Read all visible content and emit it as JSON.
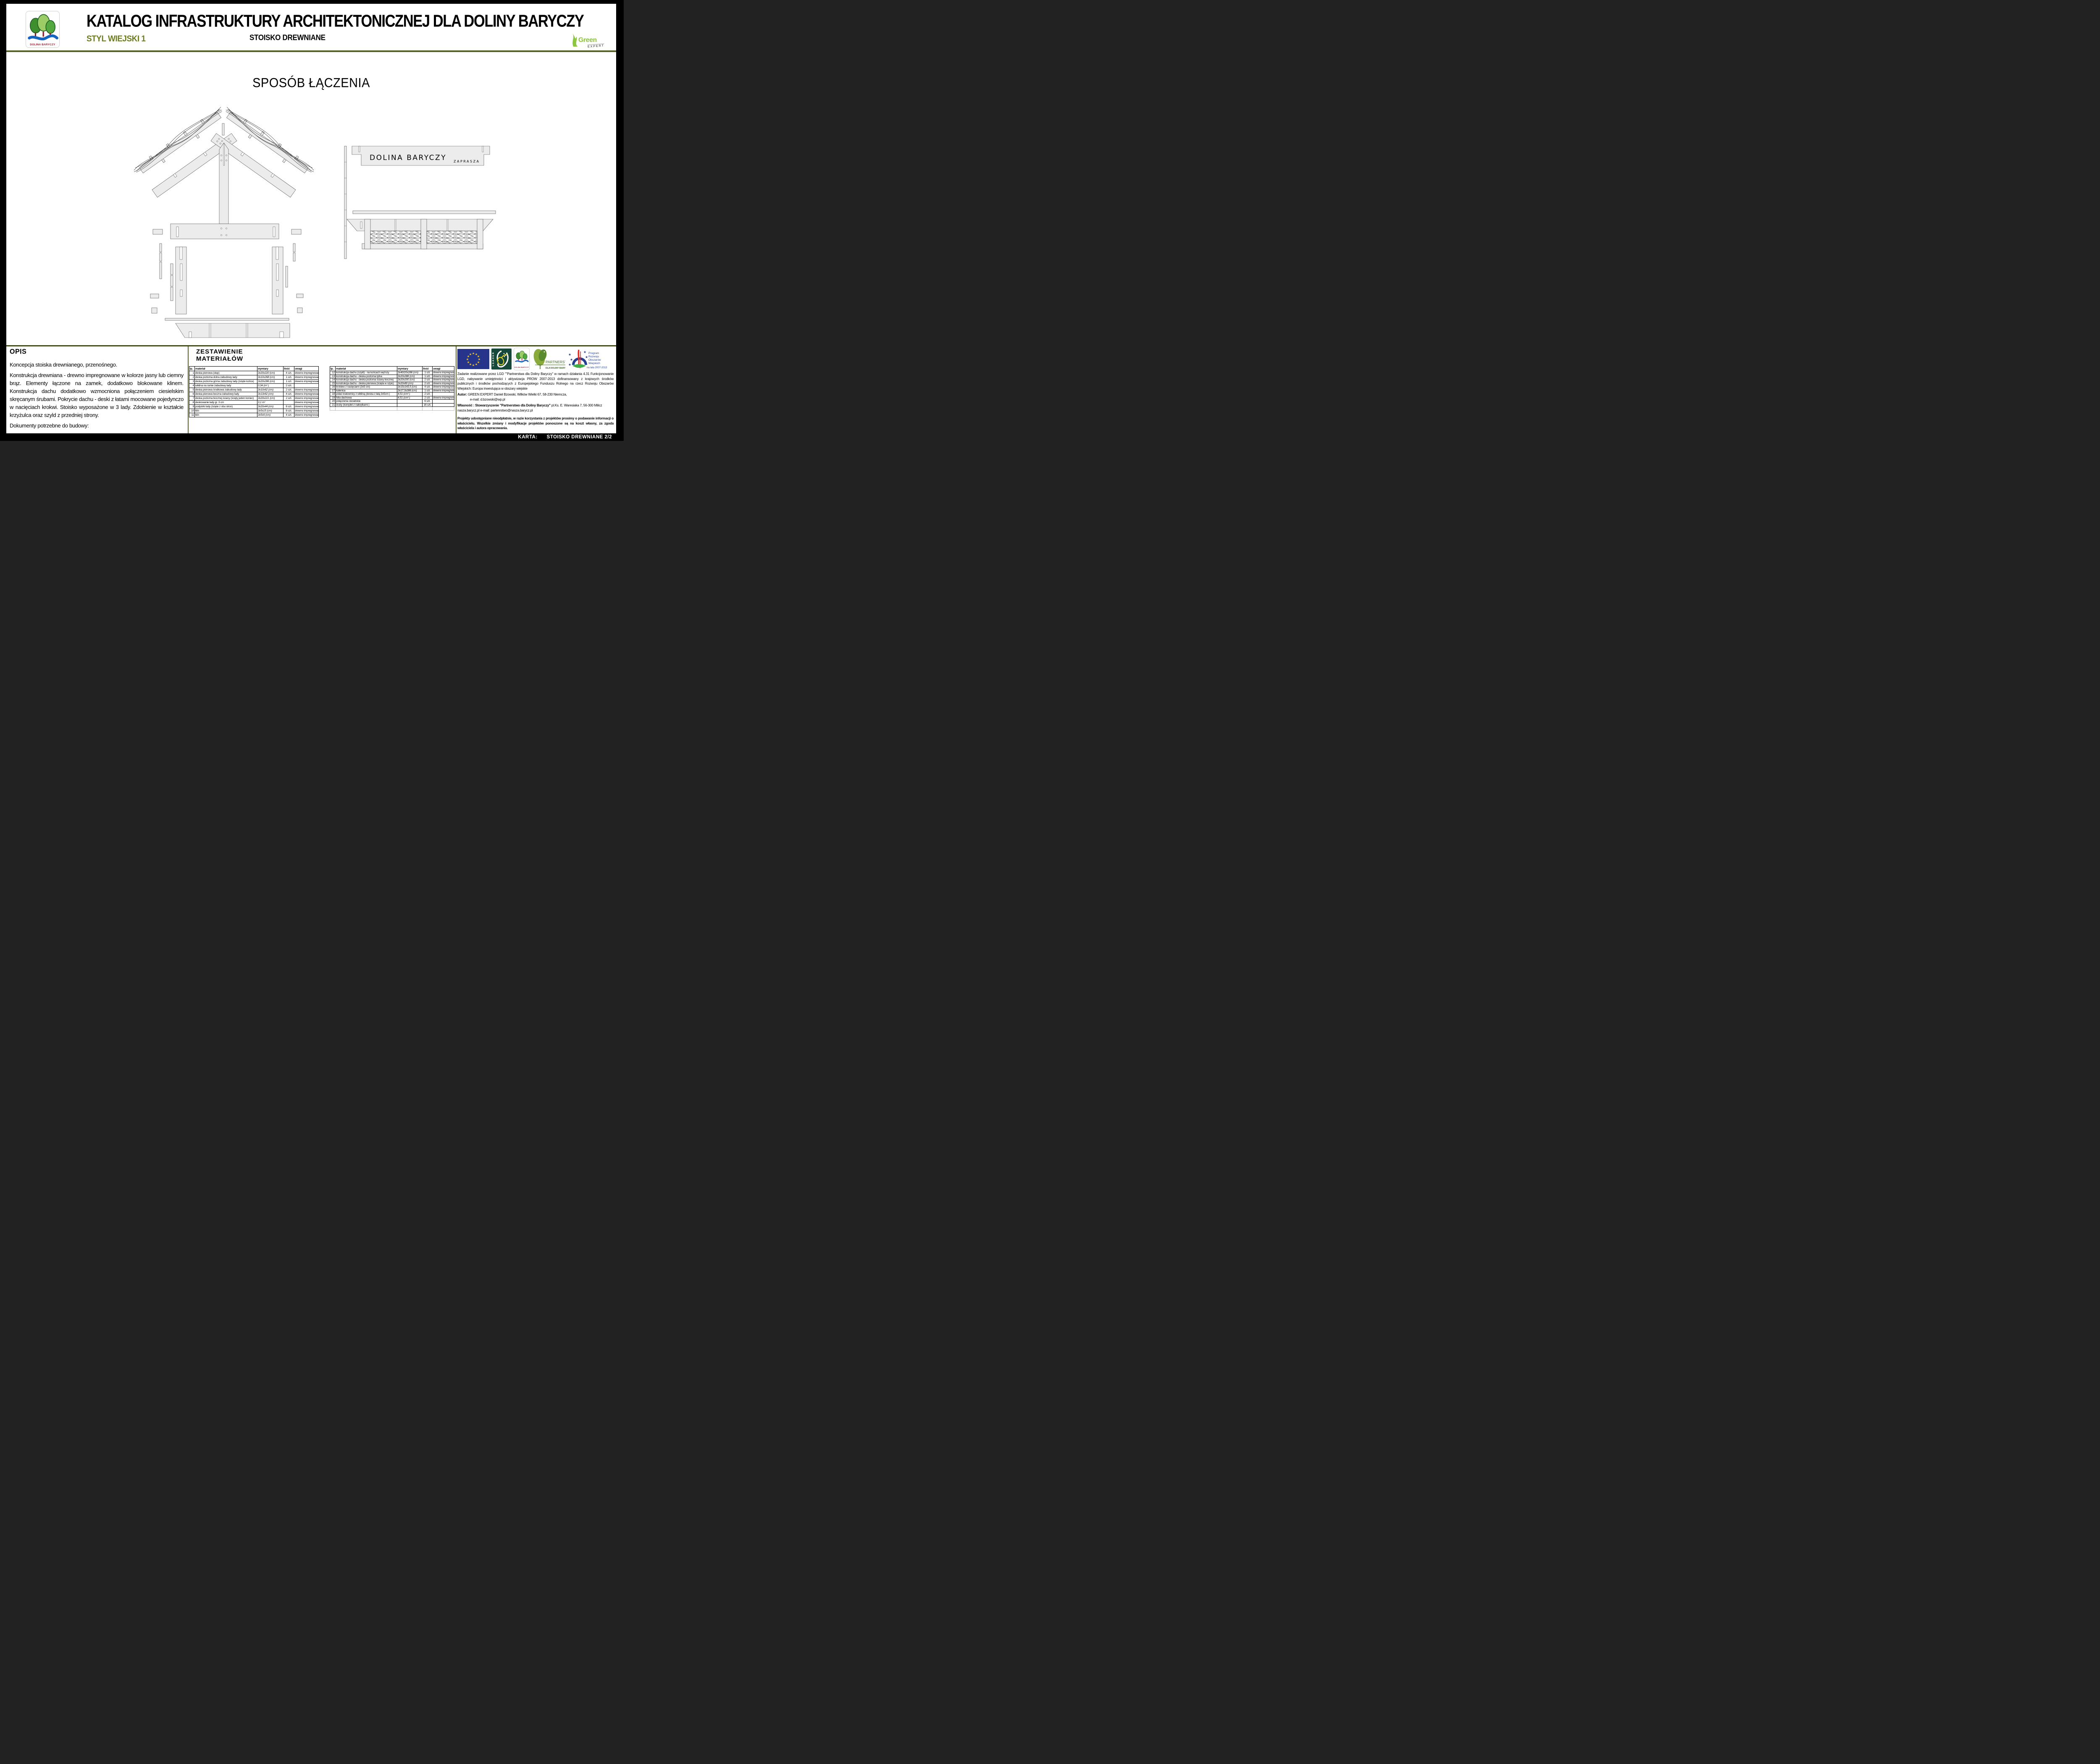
{
  "colors": {
    "accent_olive": "#6b7d1e",
    "rule_olive": "#55622a",
    "eu_blue": "#27348b",
    "star_yellow": "#ffd500",
    "green_expert": "#8dc63f",
    "logo_red": "#a21c2c",
    "prow_blue": "#243f8f",
    "partner_green": "#3e6b22",
    "drawing_fill": "#ececec"
  },
  "header": {
    "title": "KATALOG INFRASTRUKTURY ARCHITEKTONICZNEJ DLA DOLINY BARYCZY",
    "style_label": "STYL WIEJSKI 1",
    "subtitle": "STOISKO DREWNIANE",
    "logo_caption": "DOLINA BARYCZY",
    "brand_green": "Green",
    "brand_expert": "EXPERT"
  },
  "drawing": {
    "heading": "SPOSÓB ŁĄCZENIA",
    "sign_text": "DOLINA BARYCZY",
    "sign_subtext": "ZAPRASZA"
  },
  "opis": {
    "heading": "OPIS",
    "p1": "Koncepcja stoiska drewnianego, przenośnego.",
    "p2": "Konstrukcja drewniana - drewno impregnowane w kolorze jasny lub ciemny brąz.  Elementy łączone na zamek, dodatkowo blokowane klinem. Konstrukcja dachu dodatkowo wzmocniona połączeniem ciesielskim skręcanym śrubami. Pokrycie dachu - deski z łatami mocowane pojedynczo w nacięciach krokwi. Stoisko wyposażone w  3 lady. Zdobienie w kształcie krzyżulca oraz szyld z przedniej strony.",
    "p3": "Dokumenty potrzebne do budowy:",
    "p4": "- obiekt przenośny (sezonowy) - zgłoszenie nie jest wymagane"
  },
  "materials": {
    "heading_line1": "ZESTAWIENIE",
    "heading_line2": "MATERIAŁÓW",
    "columns": [
      "lp.",
      "materiał",
      "wymiary",
      "ilość",
      "uwagi"
    ],
    "left_rows": [
      [
        "1",
        "deska pionowa (słup)",
        "3x20x220 (cm)",
        "4 szt.",
        "drewno impregnowane"
      ],
      [
        "2",
        "deska pozioma dolna zabudowy lady",
        "3x10x268 (cm)",
        "1 szt.",
        "drewno impregnowane"
      ],
      [
        "3",
        "deska pozioma górna zabudowy lady (ścięte końce)",
        "3x20x286 (cm)",
        "1 szt.",
        "drewno impregnowane"
      ],
      [
        "4",
        "wiklina na ramie zabudowy lady",
        "0,34 (m² )",
        "2 szt.",
        ""
      ],
      [
        "5",
        "deska pionowa środkowa zabudowy lady",
        "3x10x62 (cm)",
        "2 szt.",
        "drewno impregnowane"
      ],
      [
        "6",
        "deska pionowa boczna zabudowy lady",
        "3x13x62 (cm)",
        "4 szt.",
        "drewno impregnowane"
      ],
      [
        "7",
        "deska pozioma bocznej ściany (ścięty jeden koniec)",
        "3x20x221 (cm)",
        "2 szt.",
        "drewno impregnowane"
      ],
      [
        "8",
        "deskowanie lady gr. 3 cm",
        "3,1 m²",
        "",
        "drewno impregnowane"
      ],
      [
        "9",
        "podpórki lady (ścięte z obu stron)",
        "3x20x44 (cm)",
        "8 szt.",
        "drewno impregnowane"
      ],
      [
        "10",
        "klin",
        "3x5x15 (cm)",
        "8 szt.",
        "drewno impregnowane"
      ],
      [
        "11",
        "klin",
        "3x5x9 (cm)",
        "4 szt.",
        "drewno impregnowane"
      ]
    ],
    "right_rows": [
      [
        "12",
        "konstrukcja dachu (szyld) - na końcach węższy",
        "3x40/20x286 (cm)",
        "1 szt.",
        "drewno impregnowane"
      ],
      [
        "13",
        "konstrukcja dachu - deska pozioma tylna",
        "3x20x286 (cm)",
        "1 szt.",
        "drewno impregnowane"
      ],
      [
        "14",
        "konstrukcja dachu - deska pozioma ściany bocznej",
        "3x20x200 (cm)",
        "2 szt.",
        "drewno impregnowane"
      ],
      [
        "15",
        "konstrukcja dachu - deska pionowa (ścięta w szpic)",
        "3x20x80 (cm)",
        "2 szt.",
        "drewno impregnowane"
      ],
      [
        "16",
        "krokiew z nacięciami (3x5 cm)",
        "3x15x143,5 (cm)",
        "4 szt.",
        "drewno impregnowane"
      ],
      [
        "17",
        "kalenica",
        "3x17,3x286 (cm)",
        "1 szt.",
        "drewno impregnowane"
      ],
      [
        "18",
        "połać kratownicy z wikliną  (deska z łatą 3x5cm )",
        "4,51 (cm² )",
        "2 szt.",
        ""
      ],
      [
        "19",
        "folia dachowa",
        "4,51 (cm² )",
        "2 szt.",
        "drewno impregnowane"
      ],
      [
        "20",
        "połączenia ciesielskie",
        "",
        "6 szt.",
        ""
      ],
      [
        "21",
        "śruby (komplet z nakrętkami )",
        "",
        "16 szt.",
        ""
      ],
      [
        "",
        "",
        "",
        "",
        ""
      ]
    ]
  },
  "footer": {
    "funding_note": "Zadanie realizowane przez LGD \"\"Partnerstwa dla Doliny Baryczy\" w ramach działania 4.31 Funkcjonowanie LGD, nabywanie umiejętności i aktywizacja PROW 2007-2013 dofinansowany z krajowych środków publicznych i środków pochodzących z Europejskiego Funduszu Rolnego na rzecz Rozwoju Obszarów Wiejskich: Europa inwestująca w obszary wiejskie",
    "autor_label": "Autor:",
    "autor_text": " GREEN EXPERT Daniel Bzowski, Wilków Wielki 67, 58-230 Niemcza,",
    "autor_email": "e-mail: d.bzowski@wp.pl",
    "wlasnosc_label": "Własność : Stowarzyszenie \"Partnerstwo dla Doliny Baryczy\"",
    "wlasnosc_text": "  pl.Ks. E. Waresiaka 7, 56-300 Milicz nasza.barycz.pl   e-mail:   partenrstwo@nasza.barycz.pl",
    "disclaimer": "Projekty udostępniane nieodpłatnie, w razie korzystania z projektów prosimy o podawanie informacji o właścicielu. Wszelkie zmiany i modyfikacje projektów ponoszone są na koszt własny, za zgoda właściciela i autora opracowania.",
    "logos": {
      "leader": "LEADER",
      "dolina": "DOLINA BARYCZY",
      "partner_line1": "PARTNERSTWO",
      "partner_line2": "DLA DOLINY BARYCZY",
      "prow_l1": "Program",
      "prow_l2": "Rozwoju",
      "prow_l3": "Obszarów",
      "prow_l4": "Wiejskich",
      "prow_l5": "na lata 2007-2013"
    }
  },
  "karta": {
    "label": "KARTA:",
    "value": "STOISKO DREWNIANE 2/2"
  }
}
